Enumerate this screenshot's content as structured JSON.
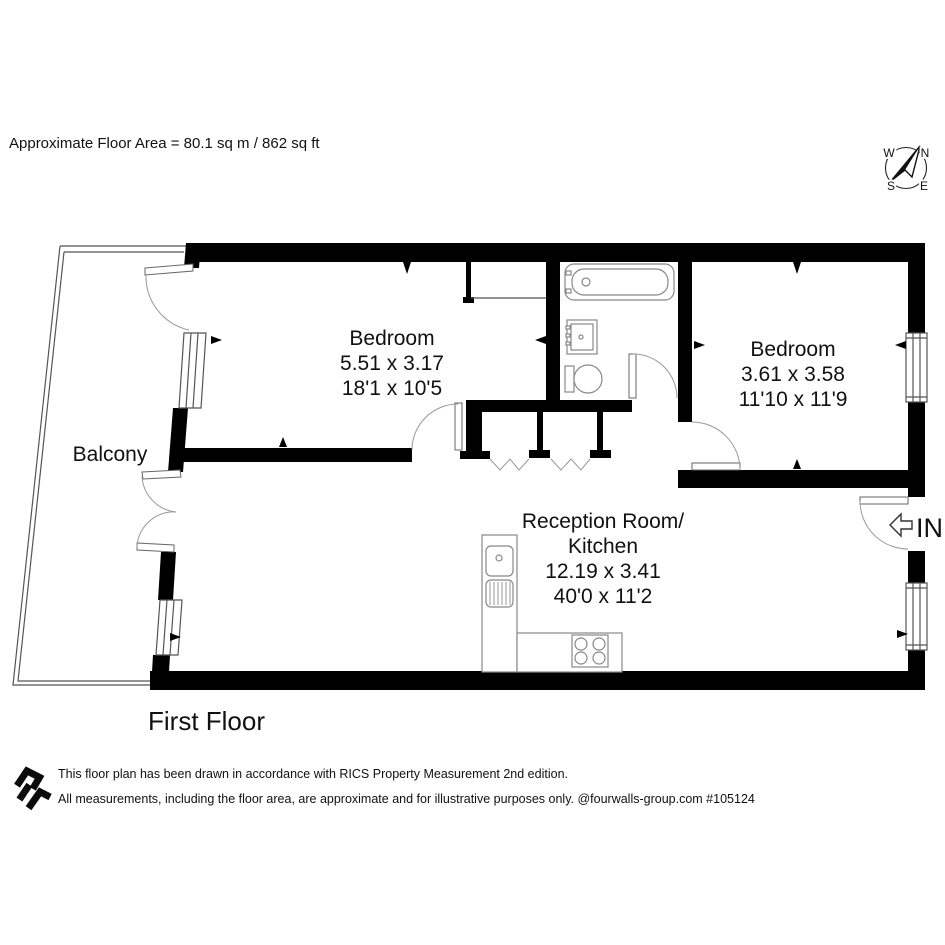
{
  "page": {
    "floor_area_note": "Approximate Floor Area = 80.1 sq m / 862 sq ft",
    "floor_label": "First Floor"
  },
  "compass": {
    "n": "N",
    "e": "E",
    "s": "S",
    "w": "W"
  },
  "rooms": {
    "bedroom1": {
      "name": "Bedroom",
      "metric": "5.51 x 3.17",
      "imperial": "18'1 x 10'5"
    },
    "bedroom2": {
      "name": "Bedroom",
      "metric": "3.61 x 3.58",
      "imperial": "11'10 x 11'9"
    },
    "reception": {
      "name_line1": "Reception Room/",
      "name_line2": "Kitchen",
      "metric": "12.19 x 3.41",
      "imperial": "40'0 x 11'2"
    },
    "balcony": {
      "name": "Balcony"
    }
  },
  "entry": {
    "label": "IN"
  },
  "footer": {
    "line1": "This floor plan has been drawn in accordance with RICS Property Measurement 2nd edition.",
    "line2": "All measurements, including the floor area, are approximate and for illustrative purposes only. @fourwalls-group.com #105124"
  },
  "colors": {
    "wall": "#000000",
    "thin_line": "#555555",
    "fixture_line": "#888888",
    "text": "#111111"
  }
}
